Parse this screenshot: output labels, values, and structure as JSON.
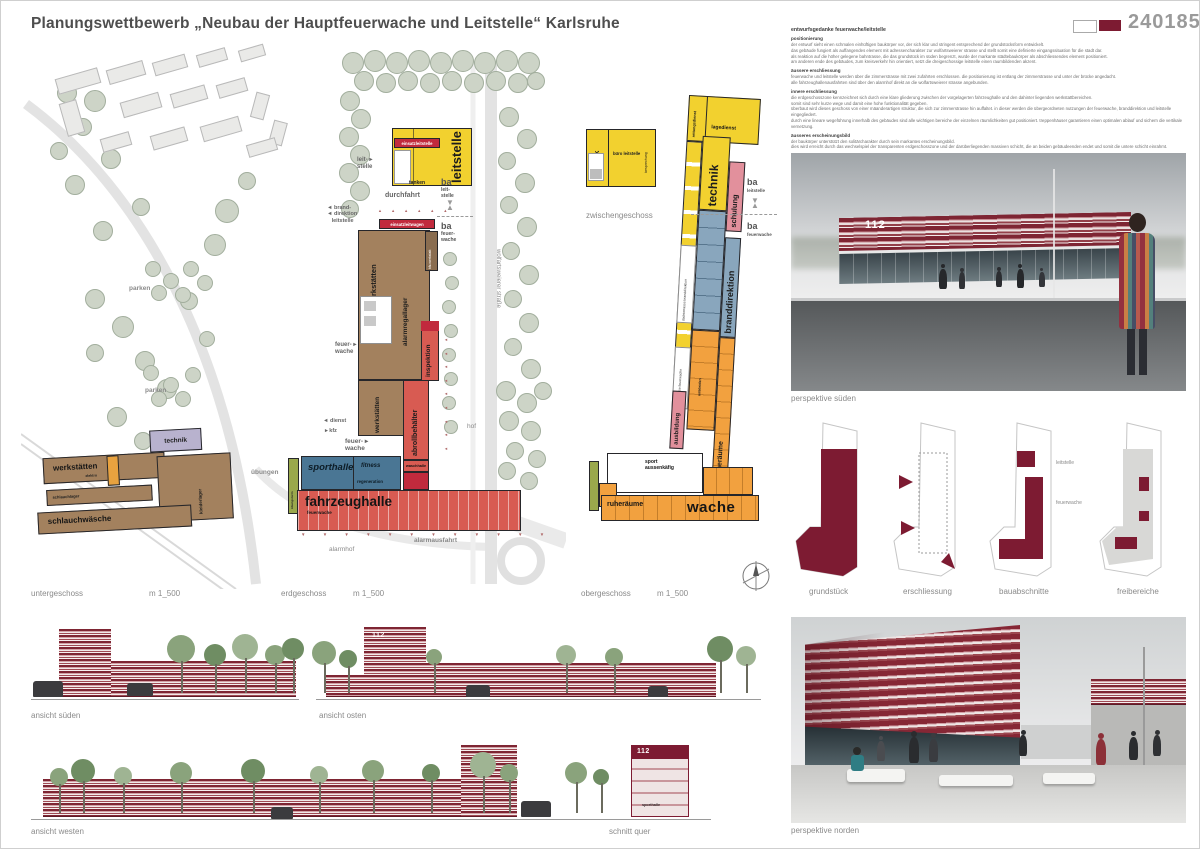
{
  "header": {
    "title": "Planungswettbewerb „Neubau der Hauptfeuerwache und Leitstelle“ Karlsruhe",
    "number": "240185"
  },
  "palette": {
    "accent": "#7d1b32",
    "plan_red": "#d85b52",
    "plan_crimson": "#c12a3d",
    "plan_yellow": "#f2d12f",
    "plan_brown": "#a3815e",
    "plan_blue": "#4a7694",
    "plan_steel": "#89a6bd",
    "plan_orange": "#f2a13f",
    "plan_pink": "#e2909c",
    "plan_lavender": "#b8b2ce",
    "plan_green": "#9aa84c",
    "tree_green": "#cdd4c7"
  },
  "glyphs": {
    "marker": "▼\n▲",
    "tri_col": "◄\n◄\n◄\n◄\n◄\n◄\n◄\n◄\n◄",
    "tri_row_up": "▲ ▲ ▲ ▲ ▲ ▲",
    "tri_row_down": "▼ ▼ ▼ ▼ ▼ ▼ ▼ ▼ ▼ ▼ ▼ ▼"
  },
  "essay": {
    "heading": "entwurfsgedanke feuerwache/leitstelle",
    "sections": [
      {
        "title": "positionierung",
        "body": "der entwurf sieht einen schmalen einhüftigen baukörper vor, der sich klar und stringent entsprechend der grundstücksform entwickelt.\ndas gebäude fungiert als auffangendes element mit adressencharakter zur wolfartsweierer strasse und stellt somit eine definierte eingangssituation für die stadt dar.\nals reaktion auf die höher gelegene bahntrasse, die das grundstück im süden begrenzt, wurde der markante städtebaukörper als abschliessendes element positioniert.\nam anderen ende des gebäudes, zum kreisverkehr hin orientiert, setzt die dreigeschossige leitstelle einen raumbildenden akzent."
      },
      {
        "title": "äussere erschliessung",
        "body": "feuerwache und leitstelle werden über die zimmerstrasse mit zwei zufahrten erschlossen. die positionierung ist entlang der zimmerstrasse und unter der brücke angedacht.\nalle fahrzeughallenausfahrten sind über den alarmhof direkt an die wolfartsweierer strasse angebunden."
      },
      {
        "title": "innere erschliessung",
        "body": "die erdgeschosszone kennzeichnet sich durch eine klare gliederung zwischen der vorgelagerten fahrzeughalle und den dahinter liegenden werkstattbereichen.\nsomit sind sehr kurze wege und damit eine hohe funktionalität gegeben.\nüberbaut wird dieses geschoss von einer mäanderartigen struktur, die sich zur zimmerstrasse hin auffaltet. in dieser werden die übergeordneten nutzungen der feuerwache, branddirektion und leitstelle eingegliedert.\ndurch eine lineare wegeführung innerhalb des gebäudes sind alle wichtigen bereiche der einzelnen räumlichkeiten gut positioniert. treppenhäuser garantieren einen optimalen ablauf und sichern die vertikale vernetzung."
      },
      {
        "title": "äusseres erscheinungsbild",
        "body": "der baukörper unterstützt den solitärcharakter durch sein markantes erscheinungsbild.\ndies wird erreicht durch das wechselspiel der transparenten erdgeschosszone und der darüberliegenden massiven schicht, die an beiden gebäudeenden endet und somit die untere schicht einrahmt."
      }
    ]
  },
  "site": {
    "street": "wolfartsweierer straße",
    "leitstelle": "leitstelle",
    "einsatzleitstelle": "einsatzleitstelle",
    "tanken": "tanken",
    "leit_stelle": "leit- ▸\nstelle",
    "durchfahrt": "durchfahrt",
    "ba1_ba": "ba",
    "ba1_sub": "leit-\nstelle",
    "ba2_ba": "ba",
    "ba2_sub": "feuer-\nwache",
    "branddirektion": "◄ brand-\n◄ direktion\n   leitstelle",
    "einsatzleitwagen": "einsatzleitwagen",
    "werkstaetten1": "werkstätten",
    "alarmregallager": "alarmregallager",
    "kfz_werkstatt": "kfz-werkstatt",
    "inspektion": "inspektion",
    "werkstaetten2": "werkstätten",
    "abrollbehaelter": "abrollbehälter",
    "waschhalle": "waschhalle",
    "feuerwache1": "feuer- ▸\nwache",
    "feuerwache2": "feuer- ▸\nwache",
    "parken1": "parken",
    "parken2": "parken",
    "dienst": "◄ dienst",
    "kfz": "▸ kfz",
    "hof": "hof",
    "uebungen": "übungen",
    "sporthalle": "sporthalle",
    "fitness": "fitness",
    "regeneration": "regeneration",
    "fahrzeughalle": "fahrzeughalle",
    "fahrzeughalle_sub": "feuerwache",
    "alarmhof": "alarmhof",
    "alarmausfahrt": "alarmausfahrt",
    "schlauchturm": "übungsturm"
  },
  "ug": {
    "technik": "technik",
    "werkstaetten": "werkstätten",
    "schlauchwaesche": "schlauchwäsche",
    "kleiderlager": "kleiderlager",
    "elektro": "elektro",
    "schlauchlager": "schlauchlager"
  },
  "zg": {
    "technik": "technik",
    "buero": "büro leitstelle",
    "besprechung": "besprechung"
  },
  "og": {
    "lagedienst": "lagedienst",
    "rettungsdienst": "rettungsdienst",
    "technik": "technik",
    "schulung": "schulung",
    "aufenthalt": "aufenthalt",
    "ba1_ba": "ba",
    "ba1_sub": "leitstelle",
    "ba2_ba": "ba",
    "ba2_sub": "feuerwache",
    "dachterrasse_bd": "dachterrasse branddirektion",
    "branddirektion": "branddirektion",
    "dachterrasse_fw": "dachterrasse feuerwache",
    "umkleiden": "umkleiden",
    "ausbildung": "ausbildung",
    "ruheraeume_v": "ruheräume",
    "sport": "sport\naussenkäfig",
    "ruheraeume": "ruheräume",
    "wache": "wache"
  },
  "captions": {
    "untergeschoss": "untergeschoss",
    "erdgeschoss": "erdgeschoss",
    "obergeschoss": "obergeschoss",
    "zwischengeschoss": "zwischengeschoss",
    "scale": "m 1_500"
  },
  "diagrams": {
    "grundstueck": "grundstück",
    "erschliessung": "erschliessung",
    "bauabschnitte": "bauabschnitte",
    "freibereiche": "freibereiche",
    "leitstelle": "leitstelle",
    "feuerwache": "feuerwache"
  },
  "views": {
    "persp_sued": "perspektive süden",
    "persp_nord": "perspektive norden",
    "ansicht_sued": "ansicht süden",
    "ansicht_ost": "ansicht osten",
    "ansicht_west": "ansicht westen",
    "schnitt": "schnitt quer",
    "sign": "112",
    "sporthalle": "sporthalle"
  }
}
